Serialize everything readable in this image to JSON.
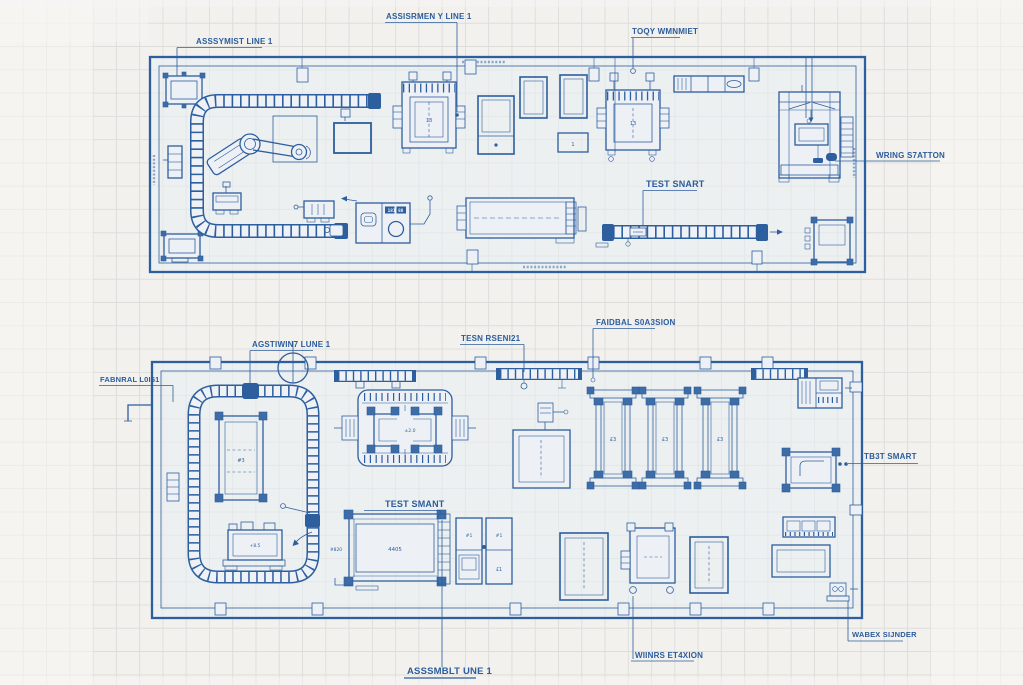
{
  "colors": {
    "ink": "#2d5e9e",
    "paper": "#f2f1ee",
    "panel": "#edf0f5",
    "grid": "#d9dad7"
  },
  "top_plan": {
    "labels": {
      "assembly_line_left": "ASSSYMIST LINE 1",
      "assembly_line_top": "ASSISRMEN Y LINE 1",
      "tool_cabinet": "TOQY WMNMIET",
      "wiring_station": "WRING S7ATTON",
      "test_station": "TEST SNART"
    },
    "machine_texts": {
      "press_left": "13",
      "press_right": "13",
      "panel_display": "181 88",
      "side_table": "1"
    }
  },
  "bottom_plan": {
    "labels": {
      "assembly_line": "AGSTIWIN7 LUNE 1",
      "test_assembly": "TESN RSENI21",
      "fabrication_station": "FAIDBAL S0A3SION",
      "fabrication_line": "FABNRAL L0I61",
      "test_station_inner": "TEST SMANT",
      "test_station_right": "TB3T SMART",
      "assembly_line_bottom": "ASSSMBLT UNE 1",
      "wiring_station": "WIINRS ET4XION",
      "work_station": "WABEX SIJNDER"
    },
    "machine_texts": {
      "pallet_table": "#3",
      "calib_table": "+8.5",
      "clamp_machine": "±2.0",
      "rail_unit": "£3",
      "test_bench": "4405",
      "bench_side": "#820",
      "cabinet_top": "#1",
      "cabinet_bottom": "£1"
    }
  }
}
